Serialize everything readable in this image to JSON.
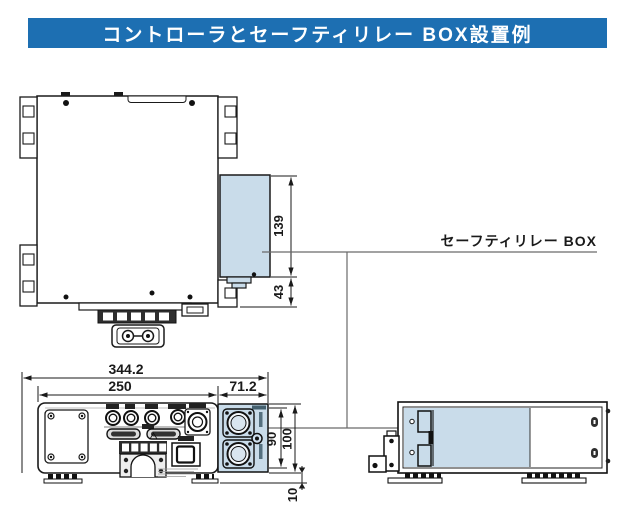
{
  "title": "コントローラとセーフティリレー BOX設置例",
  "callout": {
    "label": "セーフティリレー BOX"
  },
  "colors": {
    "header_bg": "#1d6fb2",
    "header_text": "#ffffff",
    "relay_box_fill": "#c9dcea",
    "line": "#1a1a1a",
    "leader": "#6a6a6a"
  },
  "dimensions": {
    "top_view": {
      "relay_box_height": "139",
      "relay_box_lower_depth": "43"
    },
    "front_view": {
      "overall_width": "344.2",
      "controller_width": "250",
      "relay_box_width": "71.2",
      "relay_box_connector_span": "90",
      "relay_box_height": "100",
      "foot_height": "10"
    }
  }
}
